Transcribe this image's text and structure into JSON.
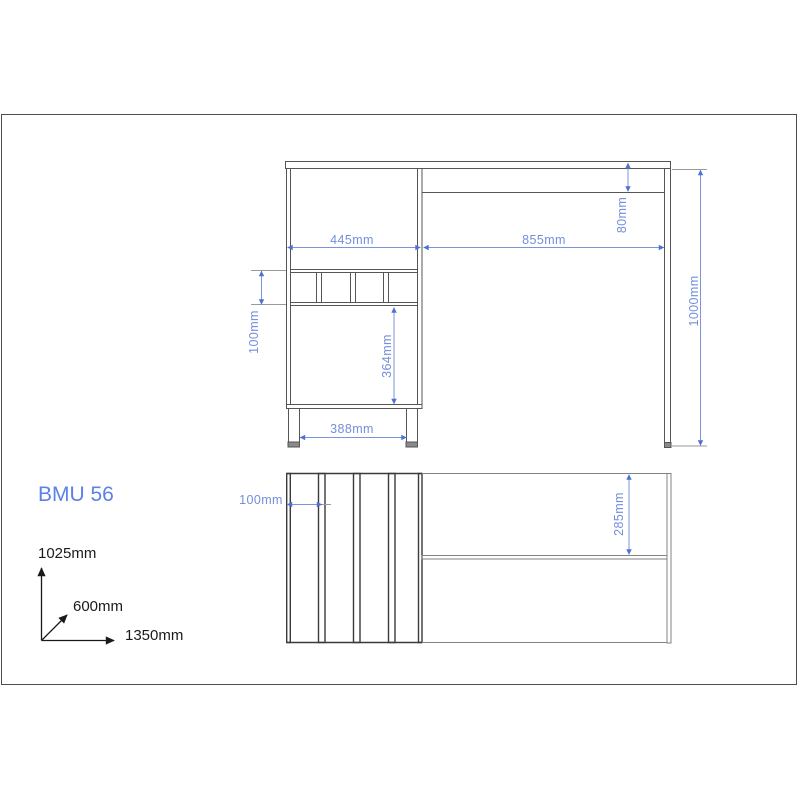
{
  "drawing": {
    "model_label": "BMU 56",
    "front_view": {
      "dimensions": {
        "cabinet_width": "445mm",
        "worktop_right_width": "855mm",
        "apron_height": "80mm",
        "overall_height": "1000mm",
        "cubby_row_height": "100mm",
        "door_height": "364mm",
        "leg_spacing": "388mm"
      }
    },
    "top_view": {
      "dimensions": {
        "cubby_slot_width": "100mm",
        "worktop_depth_to_rail": "285mm"
      }
    },
    "overall_size_axes": {
      "height": "1025mm",
      "depth": "600mm",
      "width": "1350mm"
    },
    "colors": {
      "dimension_text": "#748fdb",
      "dimension_line": "#7b94da",
      "dimension_arrow": "#4f71d4",
      "model_text": "#5b82e6",
      "outline_gray": "#555555",
      "axis_text": "#1a1a1a",
      "border_gray": "#4d4d4d"
    }
  }
}
